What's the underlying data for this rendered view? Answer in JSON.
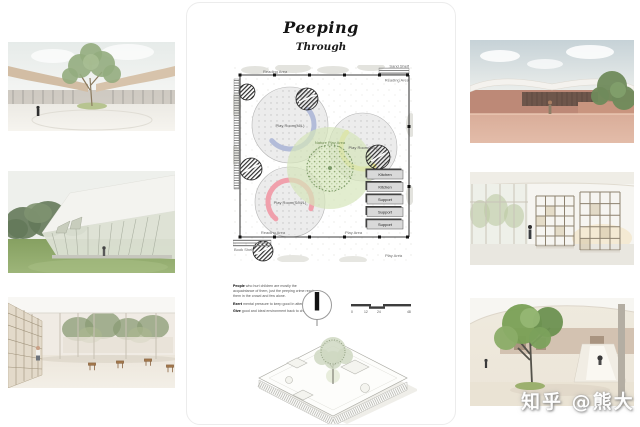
{
  "page": {
    "watermark": "知乎 @熊大"
  },
  "board": {
    "title": "Peeping",
    "subtitle": "Through",
    "plan": {
      "labels": {
        "top_left": "Reading Area",
        "shelf_top": "Sand Shelf",
        "top_right": "Reading Area",
        "room_ml_1": "Play Room(M/L)",
        "room_ml_2": "Play Room(M/L)",
        "room_sml": "Play Room(S/M/L)",
        "nature": "Nature Play Area",
        "reading_bottom": "Reading Area",
        "book_shelf": "Book Shelf",
        "play_area_mid": "Play Area",
        "play_area_bottom": "Play Area"
      },
      "legend": [
        "Kitchen",
        "Kitchen",
        "Support",
        "Support",
        "Support"
      ],
      "colors": {
        "arc_blue": "#b3bcd9",
        "arc_yellow": "#e9e48e",
        "arc_pink": "#f0a0ac",
        "nature_green": "#d5e5ba"
      }
    },
    "description": [
      {
        "lead": "People",
        "text": "who hurt children are mostly the acquaintance of them, just the peeping crime reach them in the crowd and few alone."
      },
      {
        "lead": "Exert",
        "text": "mental pressure to keep good in attention."
      },
      {
        "lead": "Give",
        "text": "good and ideal environment back to children."
      }
    ],
    "scale_ticks": [
      "0",
      "12",
      "24",
      "48"
    ]
  }
}
